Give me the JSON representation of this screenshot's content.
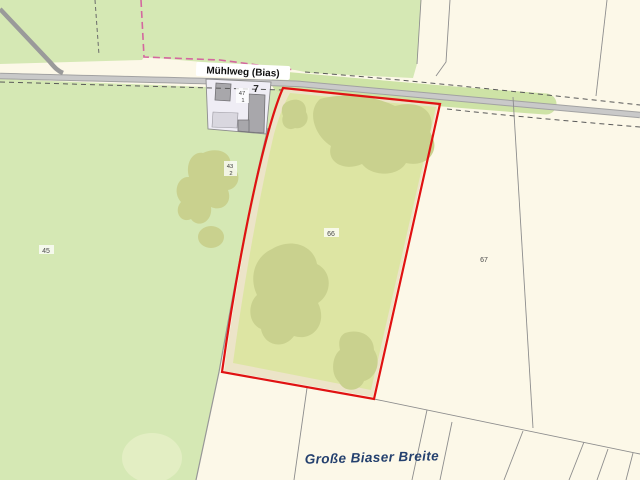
{
  "map": {
    "road_label": "Mühlweg (Bias)",
    "area_label": "Große Biaser Breite",
    "house_number": "7",
    "parcels": {
      "p45": "45",
      "p66": "66",
      "p67": "67",
      "p47_1": {
        "num": "47",
        "den": "1"
      },
      "p43_2": {
        "num": "43",
        "den": "2"
      }
    },
    "colors": {
      "field_cream": "#fcf8e8",
      "meadow_green": "#d5e8b4",
      "meadow_light": "#e3eec3",
      "scrub_olive": "#dde5a3",
      "scrub_dark": "#c9d18e",
      "verge_green": "#cee3a6",
      "road_gray": "#c9c9c9",
      "road_casing": "#a2a2a2",
      "parcel_line": "#8d8d8d",
      "boundary_pink": "#d4679f",
      "selection_red": "#e01212",
      "building_gray": "#a8a7ab",
      "building_lot": "#efedf5",
      "path_beige": "#ece4c8",
      "label_navy": "#24406e"
    }
  }
}
